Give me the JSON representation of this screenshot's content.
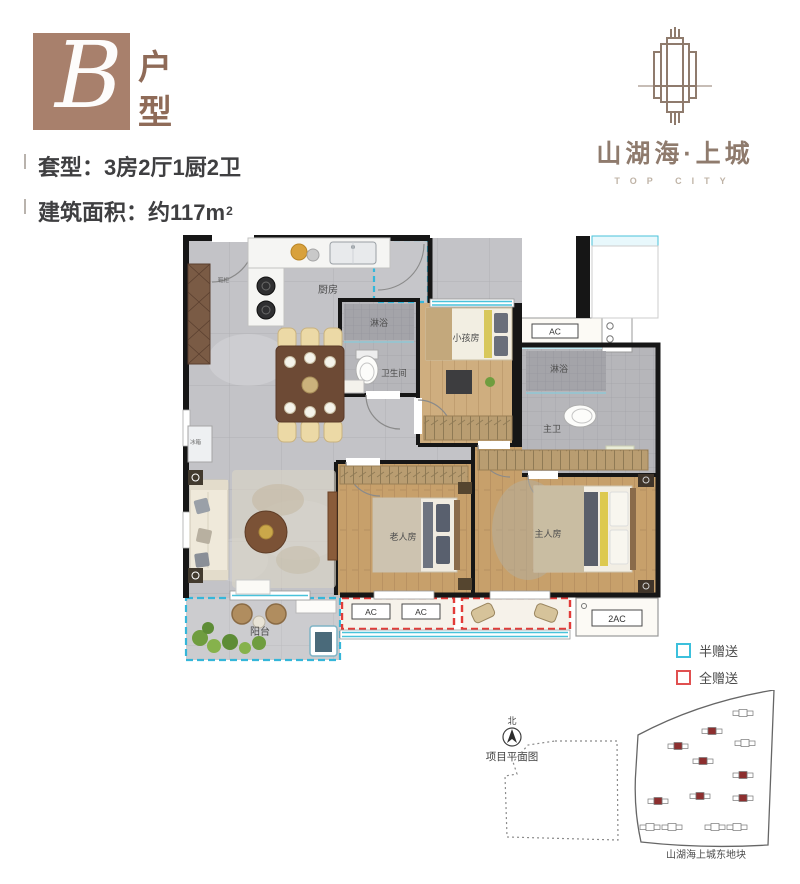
{
  "header": {
    "unit_letter": "B",
    "unit_label": "户型",
    "spec_type": "套型：3房2厅1厨2卫",
    "spec_area": "建筑面积：约117m",
    "spec_area_sup": "2"
  },
  "logo": {
    "name": "山湖海·上城",
    "subtitle": "TOP CITY"
  },
  "plan": {
    "rooms": {
      "kitchen": "厨房",
      "shower_guest": "淋浴",
      "bathroom_guest": "卫生间",
      "kids_room": "小孩房",
      "shower_master": "淋浴",
      "bathroom_master": "主卫",
      "elder_room": "老人房",
      "master_room": "主人房",
      "balcony": "阳台",
      "shoe_cabinet": "鞋柜",
      "fridge": "冰箱"
    },
    "ac": {
      "unit1": "AC",
      "unit2": "AC",
      "unit3": "AC",
      "double": "2AC"
    }
  },
  "legend": {
    "half": {
      "label": "半赠送",
      "color": "#3cc0dc"
    },
    "full": {
      "label": "全赠送",
      "color": "#e05050"
    }
  },
  "siteplan": {
    "north_label": "北",
    "caption": "项目平面图",
    "plot_label": "山湖海上城东地块"
  },
  "colors": {
    "badge_brown": "#a8806c",
    "logo_brown": "#8f7b6d",
    "wall_black": "#161616",
    "window_cyan": "#49c2da",
    "gift_half_cyan": "#35b6d9",
    "gift_full_red": "#e23b38"
  }
}
